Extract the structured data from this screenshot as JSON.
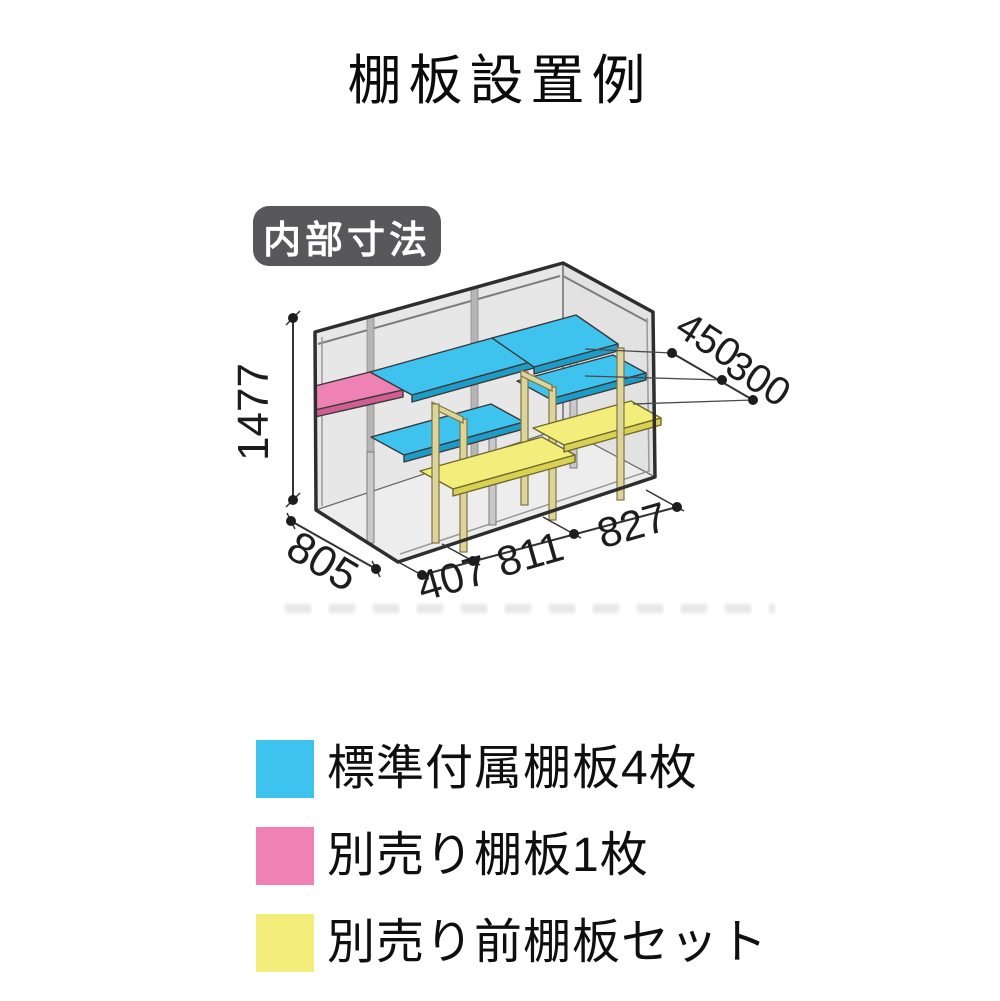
{
  "title": "棚板設置例",
  "diagram": {
    "badge_label": "内部寸法",
    "dimensions": {
      "height": "1477",
      "depth": "805",
      "width_sections": [
        "407",
        "811",
        "827"
      ],
      "shelf_depths": [
        "450",
        "300"
      ]
    }
  },
  "legend": {
    "items": [
      {
        "id": "standard-shelf",
        "label": "標準付属棚板4枚",
        "color": "#3EC3EF"
      },
      {
        "id": "optional-shelf",
        "label": "別売り棚板1枚",
        "color": "#EE82B4"
      },
      {
        "id": "optional-front-shelf-set",
        "label": "別売り前棚板セット",
        "color": "#F3EE7C"
      }
    ]
  },
  "colors": {
    "badge_bg": "#58585A",
    "outline": "#2E2E2E",
    "wall": "#E7E7E7",
    "shelf_blue": "#3EC3EF",
    "shelf_pink": "#EE82B4",
    "shelf_yellow": "#F3EE7C",
    "frame_post": "#DDD49B",
    "dimension_text": "#1D1D1D"
  }
}
